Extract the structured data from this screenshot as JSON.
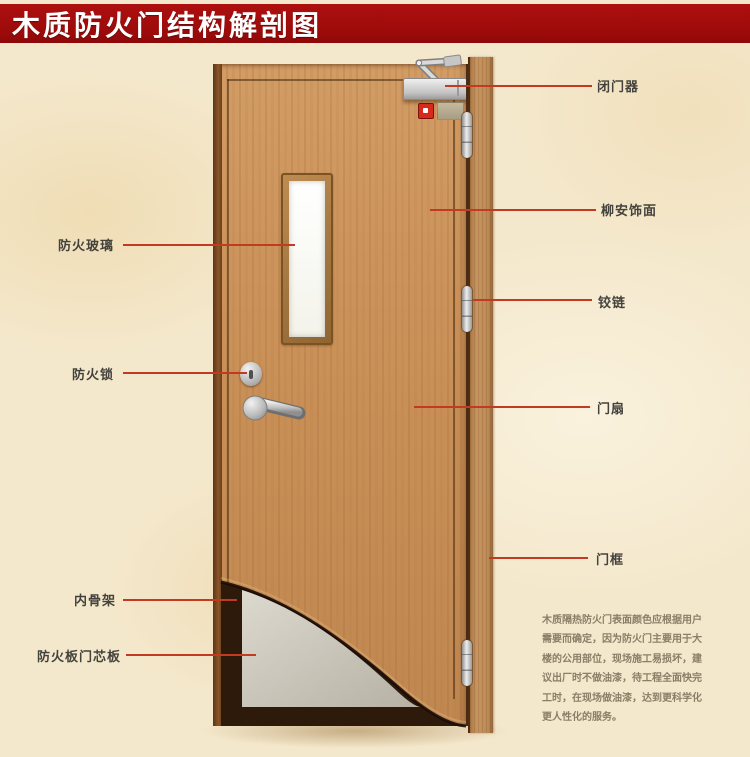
{
  "title": "木质防火门结构解剖图",
  "labels": {
    "fire_glass": "防火玻璃",
    "fire_lock": "防火锁",
    "inner_skeleton": "内骨架",
    "fire_core_board": "防火板门芯板",
    "door_closer": "闭门器",
    "lauan_veneer": "柳安饰面",
    "hinge": "铰链",
    "door_leaf": "门扇",
    "door_frame": "门框"
  },
  "description": "木质隔热防火门表面颜色应根据用户\n需要而确定，因为防火门主要用于大\n楼的公用部位，现场施工易损坏，建\n议出厂时不做油漆，待工程全面快完\n工时，在现场做油漆，达到更科学化\n更人性化的服务。",
  "colors": {
    "banner_red": "#9c0a0a",
    "leader_red": "#c23a22",
    "label_text": "#44423d",
    "paragraph_text": "#8a7e68",
    "wood": "#c88f56",
    "wood_edge_dark": "#5e3514",
    "cutaway_dark": "#2d1a0b",
    "core_gray": "#d8d5cb",
    "metal": "#cdcdcd",
    "glass": "#fbfbf6",
    "background_parchment": "#f4e8cc"
  }
}
